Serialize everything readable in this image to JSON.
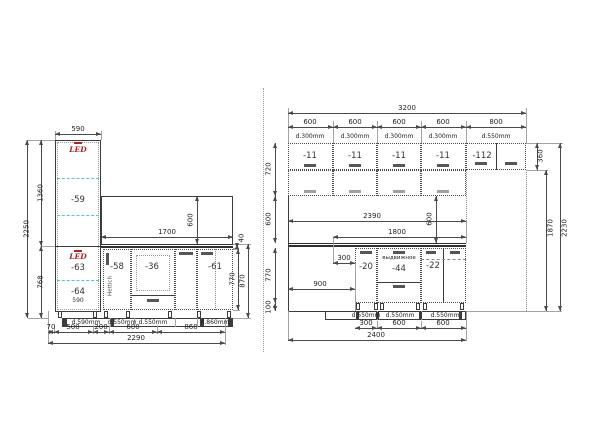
{
  "colors": {
    "line": "#3c3c3c",
    "accent_red": "#b22020",
    "shelf_cyan": "#4cc9c9",
    "text": "#1f1f1f"
  },
  "left": {
    "cabinets": {
      "tall_top": "-59",
      "tall_mid": "-63",
      "tall_bottom": "-64",
      "narrow": "-58",
      "drawer": "-36",
      "wide": "-61"
    },
    "notes": {
      "led_top": "LED",
      "led_bottom": "LED",
      "hinge": "Hettich",
      "inner_width": "590"
    },
    "depths": [
      "d.590mm",
      "d.550mm",
      "d.550mm",
      "d.860mm"
    ],
    "dims": {
      "top_width": "590",
      "height_total": "2250",
      "height_upper": "1360",
      "height_lower": "768",
      "opening_width": "1700",
      "opening_height": "600",
      "counter": "40",
      "base_height": "770",
      "base_full": "870",
      "floor": [
        "70",
        "500",
        "200",
        "600",
        "860"
      ],
      "floor_total": "2290"
    }
  },
  "right": {
    "wall_cabinets": {
      "labels": [
        "-11",
        "-11",
        "-11",
        "-11",
        "-112"
      ],
      "depths": [
        "d.300mm",
        "d.300mm",
        "d.300mm",
        "d.300mm",
        "d.550mm"
      ]
    },
    "base_cabinets": {
      "labels": [
        "-20",
        "-44",
        "-22"
      ],
      "note": "выдвижное",
      "depths": [
        "d.550mm",
        "d.550mm",
        "d.550mm"
      ]
    },
    "dims": {
      "total_width": "3200",
      "top_segments": [
        "600",
        "600",
        "600",
        "600",
        "800"
      ],
      "wall_height": "720",
      "splash": "600",
      "splash_right": "600",
      "counter_span": "2390",
      "upper_span": "1800",
      "offset": "300",
      "left_gap": "900",
      "base_height": "770",
      "plinth": "100",
      "fridge_cab": "360",
      "niche": "1870",
      "height_total": "2230",
      "floor_segments": [
        "300",
        "600",
        "600"
      ],
      "floor_total": "2400"
    }
  }
}
